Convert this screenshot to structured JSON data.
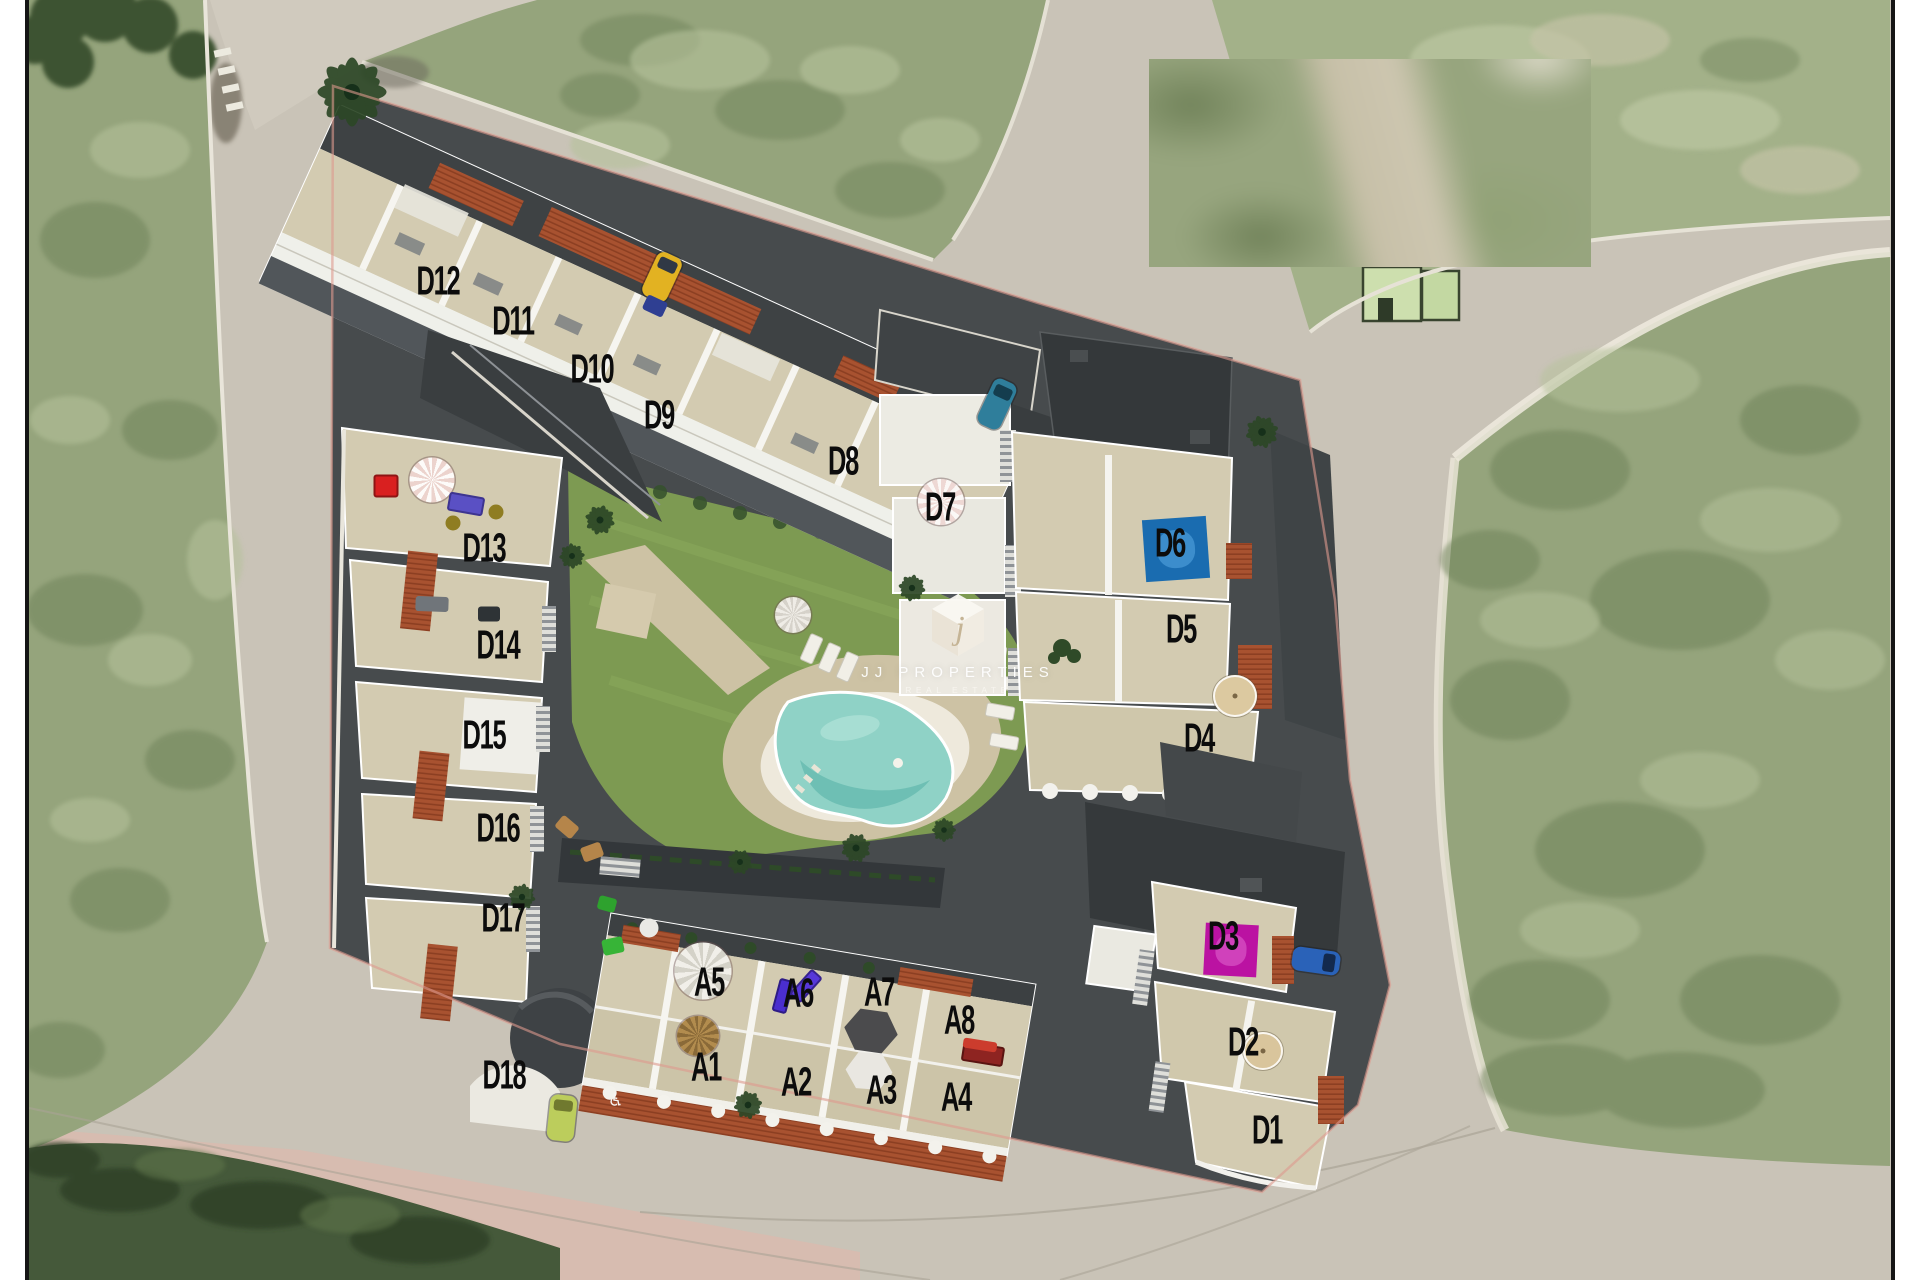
{
  "watermark": {
    "brand": "JJ PROPERTIES",
    "tagline": "REAL ESTATE",
    "monogram": "j"
  },
  "unit_labels": [
    {
      "text": "D12",
      "x": 438,
      "y": 281
    },
    {
      "text": "D11",
      "x": 513,
      "y": 321
    },
    {
      "text": "D10",
      "x": 592,
      "y": 369
    },
    {
      "text": "D9",
      "x": 659,
      "y": 415
    },
    {
      "text": "D8",
      "x": 843,
      "y": 461
    },
    {
      "text": "D7",
      "x": 940,
      "y": 507
    },
    {
      "text": "D6",
      "x": 1170,
      "y": 543
    },
    {
      "text": "D5",
      "x": 1181,
      "y": 629
    },
    {
      "text": "D4",
      "x": 1199,
      "y": 738
    },
    {
      "text": "D3",
      "x": 1223,
      "y": 936
    },
    {
      "text": "D2",
      "x": 1243,
      "y": 1042
    },
    {
      "text": "D1",
      "x": 1267,
      "y": 1130
    },
    {
      "text": "D13",
      "x": 484,
      "y": 548
    },
    {
      "text": "D14",
      "x": 498,
      "y": 645
    },
    {
      "text": "D15",
      "x": 484,
      "y": 735
    },
    {
      "text": "D16",
      "x": 498,
      "y": 828
    },
    {
      "text": "D17",
      "x": 503,
      "y": 918
    },
    {
      "text": "D18",
      "x": 504,
      "y": 1075
    },
    {
      "text": "A5",
      "x": 709,
      "y": 982
    },
    {
      "text": "A6",
      "x": 798,
      "y": 993
    },
    {
      "text": "A7",
      "x": 879,
      "y": 992
    },
    {
      "text": "A8",
      "x": 959,
      "y": 1020
    },
    {
      "text": "A1",
      "x": 706,
      "y": 1067
    },
    {
      "text": "A2",
      "x": 796,
      "y": 1082
    },
    {
      "text": "A3",
      "x": 881,
      "y": 1090
    },
    {
      "text": "A4",
      "x": 956,
      "y": 1097
    }
  ],
  "markers": [
    {
      "name": "yellow-car",
      "shape": "car",
      "x": 662,
      "y": 277,
      "w": 27,
      "h": 48,
      "rot": 25,
      "color": "#e2b222",
      "color2": "#303845"
    },
    {
      "name": "blue-trailer",
      "shape": "rect",
      "x": 655,
      "y": 306,
      "w": 22,
      "h": 16,
      "rot": 25,
      "color": "#2f3f92"
    },
    {
      "name": "teal-car",
      "shape": "car",
      "x": 997,
      "y": 404,
      "w": 25,
      "h": 50,
      "rot": 25,
      "color": "#2f7e9b",
      "color2": "#143d4e"
    },
    {
      "name": "blue-car",
      "shape": "car",
      "x": 1316,
      "y": 961,
      "w": 24,
      "h": 48,
      "rot": 98,
      "color": "#2a62b8",
      "color2": "#13294d"
    },
    {
      "name": "green-car",
      "shape": "car",
      "x": 562,
      "y": 1118,
      "w": 27,
      "h": 46,
      "rot": 6,
      "color": "#bccd5c",
      "color2": "#70792f"
    },
    {
      "name": "red-armchair",
      "shape": "rect",
      "x": 386,
      "y": 486,
      "w": 25,
      "h": 23,
      "rot": 0,
      "color": "#d92020",
      "color2": "#8e1414"
    },
    {
      "name": "pink-parasol",
      "shape": "umbrella",
      "x": 432,
      "y": 480,
      "w": 45,
      "h": 45,
      "rot": 0,
      "color": "#ecd3cd",
      "color2": "#fdfbf9"
    },
    {
      "name": "purple-lounger",
      "shape": "rect",
      "x": 466,
      "y": 504,
      "w": 36,
      "h": 19,
      "rot": 10,
      "color": "#5a50c4",
      "color2": "#3d3490"
    },
    {
      "name": "olive-pouf-1",
      "shape": "circle",
      "x": 453,
      "y": 523,
      "w": 15,
      "h": 15,
      "rot": 0,
      "color": "#8f7d22"
    },
    {
      "name": "olive-pouf-2",
      "shape": "circle",
      "x": 496,
      "y": 512,
      "w": 15,
      "h": 15,
      "rot": 0,
      "color": "#8f7d22"
    },
    {
      "name": "d6-roof-pool",
      "shape": "pool",
      "x": 1176,
      "y": 549,
      "w": 64,
      "h": 62,
      "rot": -4,
      "color": "#1a6cb0",
      "color2": "#4b9bd8"
    },
    {
      "name": "d3-roof-pool",
      "shape": "pool",
      "x": 1231,
      "y": 950,
      "w": 53,
      "h": 52,
      "rot": 3,
      "color": "#bb12a2",
      "color2": "#d955c6"
    },
    {
      "name": "d7-parasol",
      "shape": "umbrella",
      "x": 941,
      "y": 502,
      "w": 46,
      "h": 46,
      "rot": 0,
      "color": "#eed8d4",
      "color2": "#fbf8f6"
    },
    {
      "name": "d4-parasol",
      "shape": "umbrella-solid",
      "x": 1235,
      "y": 696,
      "w": 44,
      "h": 42,
      "rot": 0,
      "color": "#dcc9a0"
    },
    {
      "name": "d2-parasol",
      "shape": "umbrella-solid",
      "x": 1263,
      "y": 1051,
      "w": 40,
      "h": 38,
      "rot": 0,
      "color": "#d9c59c"
    },
    {
      "name": "a5-parasol",
      "shape": "umbrella",
      "x": 703,
      "y": 971,
      "w": 57,
      "h": 57,
      "rot": 0,
      "color": "#f1efe9",
      "color2": "#d4d2c8"
    },
    {
      "name": "a6-lounger-1",
      "shape": "rect",
      "x": 783,
      "y": 996,
      "w": 15,
      "h": 34,
      "rot": 15,
      "color": "#4a2ecf",
      "color2": "#2e1c86"
    },
    {
      "name": "a6-lounger-2",
      "shape": "rect",
      "x": 806,
      "y": 986,
      "w": 15,
      "h": 34,
      "rot": 42,
      "color": "#5738da",
      "color2": "#37228e"
    },
    {
      "name": "a3-umbrella",
      "shape": "hex",
      "x": 871,
      "y": 1031,
      "w": 54,
      "h": 47,
      "rot": 8,
      "color": "#4b4b4d"
    },
    {
      "name": "a3-table",
      "shape": "hex",
      "x": 869,
      "y": 1071,
      "w": 47,
      "h": 41,
      "rot": 4,
      "color": "#e9e7e1"
    },
    {
      "name": "a4-bbq",
      "shape": "rect",
      "x": 983,
      "y": 1054,
      "w": 42,
      "h": 20,
      "rot": 9,
      "color": "#8e2421",
      "color2": "#5a1411"
    },
    {
      "name": "a4-bbq-top",
      "shape": "rect",
      "x": 980,
      "y": 1045,
      "w": 34,
      "h": 10,
      "rot": 9,
      "color": "#cc3c2d"
    },
    {
      "name": "a1-dry-palm",
      "shape": "umbrella",
      "x": 698,
      "y": 1036,
      "w": 42,
      "h": 40,
      "rot": 0,
      "color": "#b28c4e",
      "color2": "#8a6a38"
    },
    {
      "name": "d14-sofa",
      "shape": "rect",
      "x": 432,
      "y": 604,
      "w": 33,
      "h": 15,
      "rot": 2,
      "color": "#70757a"
    },
    {
      "name": "d14-window",
      "shape": "rect",
      "x": 489,
      "y": 614,
      "w": 22,
      "h": 15,
      "rot": 0,
      "color": "#2e3336"
    },
    {
      "name": "d16-wood-chair-1",
      "shape": "rect",
      "x": 567,
      "y": 827,
      "w": 21,
      "h": 15,
      "rot": 40,
      "color": "#b5854a"
    },
    {
      "name": "d16-wood-chair-2",
      "shape": "rect",
      "x": 592,
      "y": 852,
      "w": 21,
      "h": 15,
      "rot": -20,
      "color": "#b5854a"
    },
    {
      "name": "d17-green-chair-1",
      "shape": "rect",
      "x": 607,
      "y": 904,
      "w": 18,
      "h": 14,
      "rot": 15,
      "color": "#2ea22e"
    },
    {
      "name": "d17-green-chair-2",
      "shape": "rect",
      "x": 613,
      "y": 946,
      "w": 21,
      "h": 16,
      "rot": -12,
      "color": "#37b437"
    },
    {
      "name": "d17-table",
      "shape": "circle",
      "x": 649,
      "y": 928,
      "w": 19,
      "h": 19,
      "rot": 0,
      "color": "#e9e9e5"
    },
    {
      "name": "pool-parasol",
      "shape": "umbrella",
      "x": 793,
      "y": 615,
      "w": 36,
      "h": 36,
      "rot": 0,
      "color": "#efece6",
      "color2": "#d6d2ca"
    },
    {
      "name": "wheelchair-symbol",
      "shape": "glyph",
      "x": 616,
      "y": 1101,
      "w": 18,
      "h": 18,
      "rot": 10,
      "color": "#f5f5f2",
      "text": "♿"
    }
  ],
  "palette": {
    "road": "#c9c3b7",
    "road-light": "#d3cdc1",
    "field": "#95a47c",
    "field-light": "#b6c29b",
    "field-dark": "#6d8158",
    "hedge": "#45593a",
    "plot-dark": "#474b4d",
    "wall": "#f2f1ec",
    "terrace": "#d3cbb1",
    "terrace2": "#ccc4a8",
    "tile": "#a85230",
    "tile-dark": "#8c3f22",
    "lawn": "#7d9a52",
    "deck": "#cdc2a4",
    "pool": "#8fd2c6",
    "pool-deep": "#68bcb0",
    "label-color": "#0c0c0c",
    "boundary": "#de9a8e",
    "pink-walk": "#dbb9ad",
    "shadow": "#3a3e40"
  }
}
